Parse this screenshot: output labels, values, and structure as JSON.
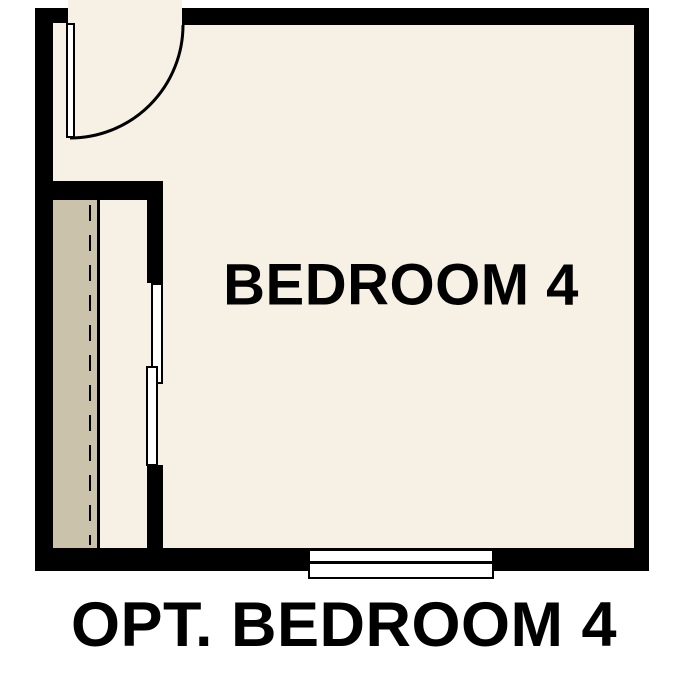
{
  "floorplan": {
    "room_label": "BEDROOM 4",
    "caption": "OPT. BEDROOM 4",
    "colors": {
      "wall": "#000000",
      "floor": "#F7F0E4",
      "closet_shade": "#CBC2AC",
      "fixture_fill": "#FFFFFF",
      "background": "#FFFFFF",
      "text": "#000000"
    },
    "symbols": {
      "door": "hinged-door-with-swing-arc",
      "closet": "closet-with-shelf-line-dashed-rod-and-bypass-sliding-doors",
      "window": "double-pane-window"
    }
  }
}
